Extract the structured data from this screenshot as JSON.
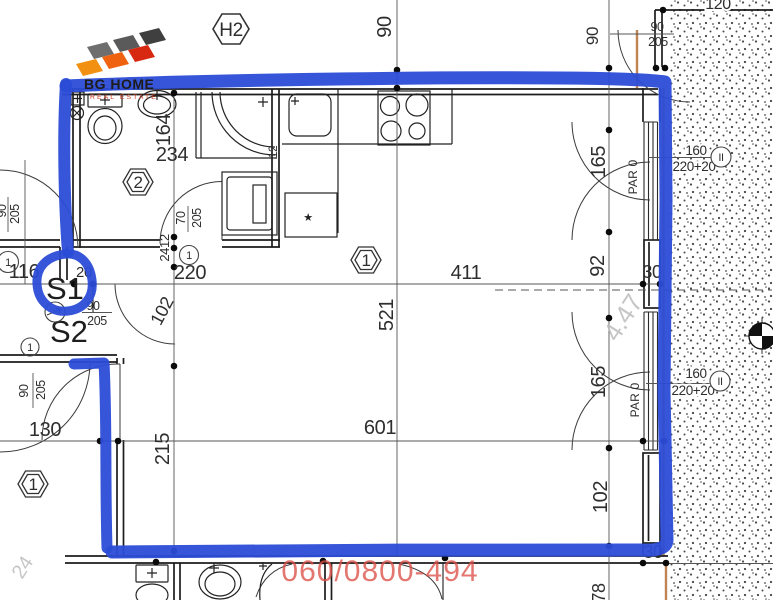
{
  "colors": {
    "marker_blue": "#2b4cd6",
    "phone_red": "#dd5048",
    "hatch_dot": "#4a4a4a",
    "wood_tan": "#c08352"
  },
  "logo": {
    "name": "BG HOME",
    "tagline": "REAL ESTATE"
  },
  "watermarks": {
    "phone": "060/0800-494",
    "elevation": "4.47",
    "corner": "24"
  },
  "plan": {
    "block": "H2",
    "s1": "S1",
    "s2": "S2",
    "room_tags": {
      "main": "1",
      "bath": "2",
      "hall": "1"
    },
    "circle_tags": {
      "left": "1",
      "mid": "1",
      "lower": "1",
      "window": "II"
    },
    "symbols": {
      "star": "★"
    },
    "dims": {
      "k_width": "90",
      "tr_width": "120",
      "tr_depth": "90",
      "tr_door_w": "90",
      "tr_door_h": "205",
      "bath_depth": "164",
      "bath_width": "234",
      "wall12": "12",
      "bathdoor_w": "70",
      "bathdoor_h": "205",
      "wall2412": "2412",
      "hall_w": "220",
      "door_sw": "102",
      "left_w": "116",
      "wall20": "20",
      "s1door_w": "90",
      "s1door_h": "205",
      "ldoor_w": "90",
      "ldoor_h": "205",
      "entry_w": "90",
      "entry_h": "205",
      "hall2_w": "130",
      "s2_depth": "215",
      "main_w": "411",
      "main_d": "521",
      "main_w2": "601",
      "win_gap": "92",
      "wall30_a": "30",
      "win1_h": "165",
      "win1_par": "PAR 0",
      "win1_w": "160",
      "win1_hh": "220+20",
      "win2_h": "165",
      "win2_par": "PAR 0",
      "win2_w": "160",
      "win2_hh": "220+20",
      "wall_b": "102",
      "wall30_b": "30",
      "d78": "78"
    }
  }
}
